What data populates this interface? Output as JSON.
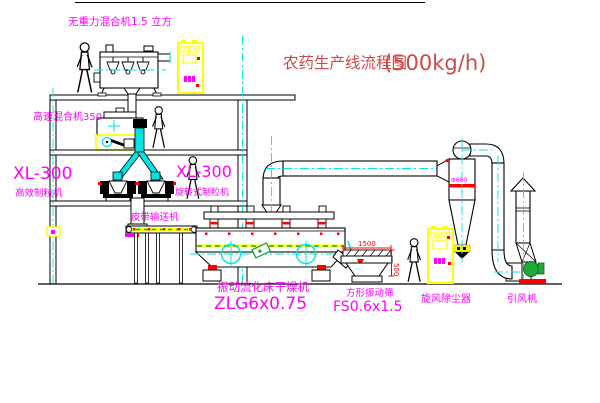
{
  "title": {
    "name": "农药生产线流程图",
    "capacity": "(500kg/h)"
  },
  "equipment": {
    "gravity_mixer": {
      "label": "无重力混合机1.5 立方"
    },
    "high_speed_mixer": {
      "label": "高速混合机350"
    },
    "granulator_left": {
      "model": "XL-300",
      "name": "高效制粒机"
    },
    "granulator_right": {
      "model": "XL-300",
      "name": "旋转式制粒机"
    },
    "belt_conveyor": {
      "label": "皮带输送机"
    },
    "fluid_bed_dryer": {
      "name": "振动流化床干燥机",
      "model": "ZLG6x0.75"
    },
    "vibrating_screen": {
      "name": "方形振动筛",
      "model": "FS0.6x1.5",
      "dim_length": "1500",
      "dim_height": "500"
    },
    "cyclone": {
      "name": "旋风除尘器",
      "diameter": "Φ600"
    },
    "fan": {
      "name": "引风机"
    }
  },
  "colors": {
    "label_magenta": "#ff00ff",
    "title_red": "#d04848",
    "dimension_red": "#ff0000",
    "pipe_cyan": "#00e5e5",
    "cabinet_yellow": "#ffff00",
    "machine_green": "#1fa83c",
    "line_black": "#000000"
  }
}
